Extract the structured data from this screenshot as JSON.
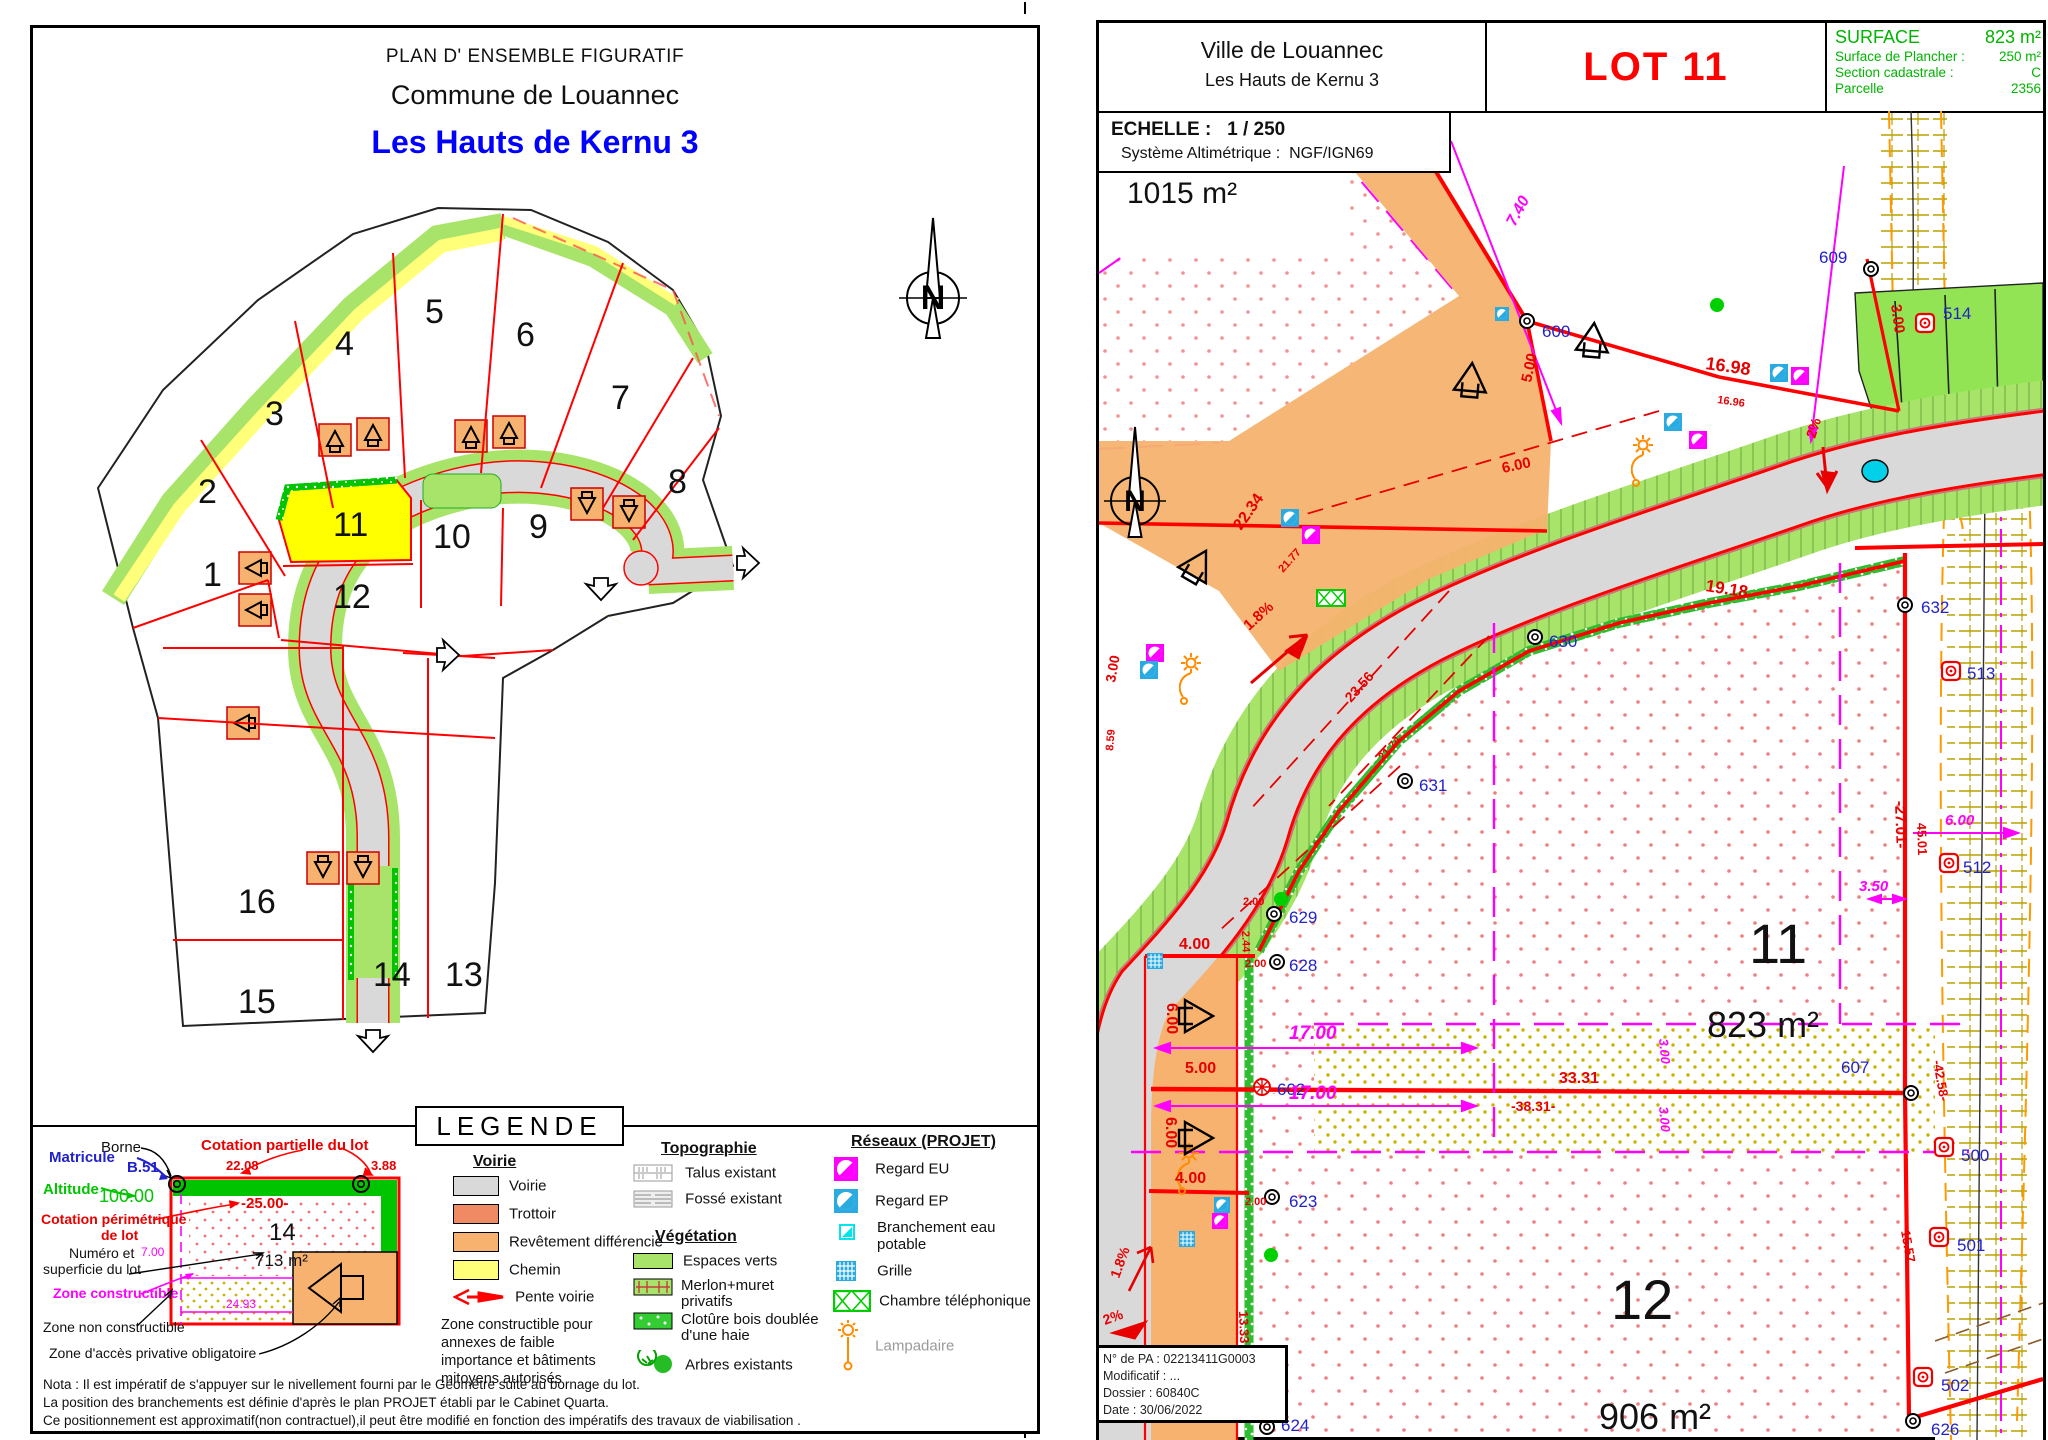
{
  "left_panel": {
    "title1": "PLAN D' ENSEMBLE FIGURATIF",
    "title2": "Commune de Louannec",
    "title3": "Les Hauts de Kernu 3",
    "lot_numbers": [
      "1",
      "2",
      "3",
      "4",
      "5",
      "6",
      "7",
      "8",
      "9",
      "10",
      "11",
      "12",
      "13",
      "14",
      "15",
      "16"
    ],
    "legend": {
      "title": "LEGENDE",
      "sample": {
        "borne_label": "Borne",
        "matricule_label": "Matricule",
        "matricule_value": "B.51",
        "altitude_label": "Altitude",
        "altitude_value": "100.00",
        "cotation_partielle_label": "Cotation partielle du lot",
        "cotation_partielle_v1": "22.08",
        "cotation_partielle_v2": "3.88",
        "cotation_perimetrique_l1": "Cotation périmétrique",
        "cotation_perimetrique_l2": "de lot",
        "cotation_perimetrique_value": "-25.00-",
        "numero_l1": "Numéro et",
        "numero_l2": "superficie du lot",
        "lot_number": "14",
        "lot_area": "713 m²",
        "dim_left": "7.00",
        "dim_bottom": "24.93",
        "zone_constructible": "Zone constructible",
        "zone_non_constructible": "Zone non constructible",
        "zone_acces": "Zone d'accès privative obligatoire"
      },
      "voirie_heading": "Voirie",
      "voirie_items": [
        "Voirie",
        "Trottoir",
        "Revêtement différencié",
        "Chemin"
      ],
      "pente_voirie": "Pente voirie",
      "zone_annexes": "Zone constructible pour annexes de faible importance et bâtiments mitoyens autorisés",
      "topographie_heading": "Topographie",
      "topo_items": [
        "Talus existant",
        "Fossé existant"
      ],
      "vegetation_heading": "Végétation",
      "veg_items": [
        "Espaces verts",
        "Merlon+muret privatifs",
        "Clotûre bois doublée d'une haie",
        "Arbres existants"
      ],
      "reseaux_heading": "Réseaux (PROJET)",
      "reseaux_items": [
        "Regard EU",
        "Regard EP",
        "Branchement eau potable",
        "Grille",
        "Chambre téléphonique",
        "Lampadaire"
      ]
    },
    "nota_line1": "Nota : Il est impératif de s'appuyer sur le nivellement fourni par le Géomètre suite au bornage du lot.",
    "nota_line2": "La position des branchements est définie d'après le plan PROJET établi par  le Cabinet Quarta.",
    "nota_line3": "Ce positionnement est approximatif(non contractuel),il peut être modifié en fonction des impératifs des travaux de viabilisation .",
    "north_label": "N"
  },
  "right_panel": {
    "header": {
      "city": "Ville de Louannec",
      "subdivision": "Les Hauts de Kernu 3",
      "lot_title": "LOT 11",
      "surface_label": "SURFACE",
      "surface_value": "823 m²",
      "plancher_label": "Surface de Plancher :",
      "plancher_value": "250 m²",
      "section_label": "Section cadastrale :",
      "section_value": "C",
      "parcelle_label": "Parcelle",
      "parcelle_value": "2356"
    },
    "echelle_label": "ECHELLE :",
    "echelle_value": "1 / 250",
    "altimetrie_label": "Système Altimétrique :",
    "altimetrie_value": "NGF/IGN69",
    "parcel_area_top": "1015 m²",
    "lot11_number": "11",
    "lot11_area": "823 m²",
    "lot12_number": "12",
    "lot12_area": "906 m²",
    "parking_letters": [
      "P",
      "P",
      "P"
    ],
    "north_label": "N",
    "markers": [
      "600",
      "609",
      "514",
      "632",
      "630",
      "631",
      "513",
      "629",
      "628",
      "602",
      "623",
      "607",
      "512",
      "500",
      "501",
      "502",
      "626",
      "624"
    ],
    "dims_red": [
      "5.00",
      "6.00",
      "16.98",
      "16.96",
      "3.00",
      "2%",
      "19.18",
      "22.34",
      "21.77",
      "1.8%",
      "23.56",
      "21.74",
      "3.00",
      "8.59",
      "2.00",
      "2.44",
      "2.00",
      "4.00",
      "6.00",
      "5.00",
      "6.00",
      "4.00",
      "2.00",
      "1.8%",
      "2%",
      "13.33",
      "33.31",
      "-38.31-",
      "-27.01-",
      "45.01",
      "-42.58-",
      "15.57"
    ],
    "dims_magenta": [
      "7.40",
      "17.00",
      "17.00",
      "3.50",
      "6.00",
      "3.00",
      "3.00"
    ],
    "info_box": {
      "line1": "N° de PA : 02213411G0003",
      "line2": "Modificatif : ...",
      "line3": "Dossier : 60840C",
      "line4": "Date : 30/06/2022"
    }
  },
  "colors": {
    "accent_blue": "#0000ff",
    "lot_red": "#ff0000",
    "green_text": "#00b400",
    "marker_blue": "#2222cc",
    "magenta": "#ff00ff",
    "road_gray": "#d9d9d9",
    "verge_green": "#a9e46a",
    "chemin_yellow": "#ffff7a",
    "trottoir": "#f08a64",
    "revetement": "#f6b26e",
    "lot11_yellow": "#ffff00"
  }
}
